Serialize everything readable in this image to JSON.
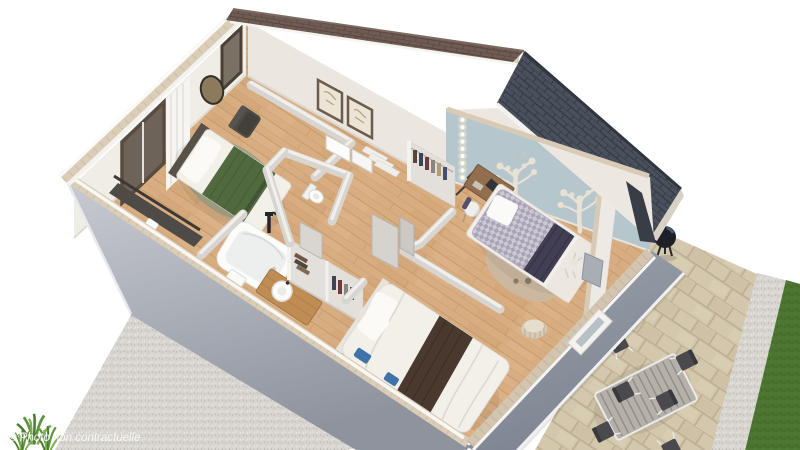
{
  "image": {
    "type": "3d-floorplan-cutaway-render",
    "width": 800,
    "height": 450
  },
  "watermark": {
    "text": "© Photo non contractuelle"
  },
  "palette": {
    "background": "#ffffff",
    "exterior_wall_light": "#c9ccd2",
    "exterior_wall_dark": "#8e939e",
    "interior_wall": "#efece6",
    "partition_wall": "#d8d5d1",
    "wall_top_brick": "#dbceb9",
    "wood_floor": "#d7ad81",
    "roof_rear_brown": "#6e5c54",
    "roof_front_gray": "#4a515d",
    "accent_wall_blue": "#b5c6cd",
    "lawn_green": "#4c7631",
    "gravel": "#d8d5d0",
    "pavers": "#d3c7ad",
    "bed_green": "#50693f",
    "bed_gingham": "#a9a3b6",
    "bed_brown_blanket": "#4a392e",
    "bed_blue_frame": "#4f81b5",
    "vanity_wood": "#bf8c54"
  },
  "scene": {
    "rooms": [
      "master-bedroom",
      "bathroom",
      "wc",
      "hallway",
      "kids-bedroom",
      "second-bedroom",
      "terrace",
      "garden"
    ],
    "objects": [
      "double-bed-green",
      "bathtub",
      "shower-column",
      "vanity-sink",
      "toilet",
      "dressing-closet",
      "kids-wardrobe",
      "kids-bed",
      "desk-and-chair",
      "double-bed-white",
      "pouf",
      "outdoor-dining-table",
      "outdoor-chairs",
      "barbecue-grill",
      "potted-grasses",
      "tree-wall-decals",
      "string-lights",
      "picture-frames",
      "mirror",
      "curtain",
      "windows",
      "armchair",
      "rugs",
      "entry-steps"
    ]
  }
}
